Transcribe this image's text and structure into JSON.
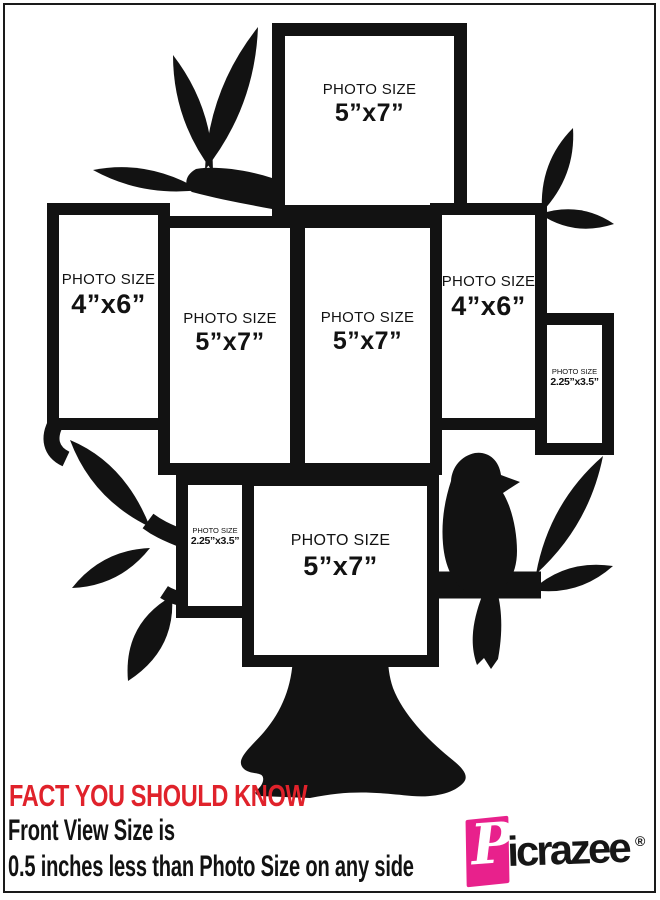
{
  "frames": [
    {
      "label": "PHOTO SIZE",
      "size": "5”x7”"
    },
    {
      "label": "PHOTO SIZE",
      "size": "4”x6”"
    },
    {
      "label": "PHOTO SIZE",
      "size": "5”x7”"
    },
    {
      "label": "PHOTO SIZE",
      "size": "5”x7”"
    },
    {
      "label": "PHOTO SIZE",
      "size": "4”x6”"
    },
    {
      "label": "PHOTO SIZE",
      "size": "2.25”x3.5”"
    },
    {
      "label": "PHOTO SIZE",
      "size": "2.25”x3.5”"
    },
    {
      "label": "PHOTO SIZE",
      "size": "5”x7”"
    }
  ],
  "footer": {
    "headline": "FACT YOU SHOULD KNOW",
    "line1": "Front View Size is",
    "line2": "0.5 inches less than Photo Size on any side"
  },
  "brand": {
    "initial": "P",
    "rest": "icrazee",
    "registered": "®"
  },
  "colors": {
    "ink": "#121212",
    "headline_red": "#e0222b",
    "brand_pink": "#e8218c",
    "background": "#ffffff"
  }
}
